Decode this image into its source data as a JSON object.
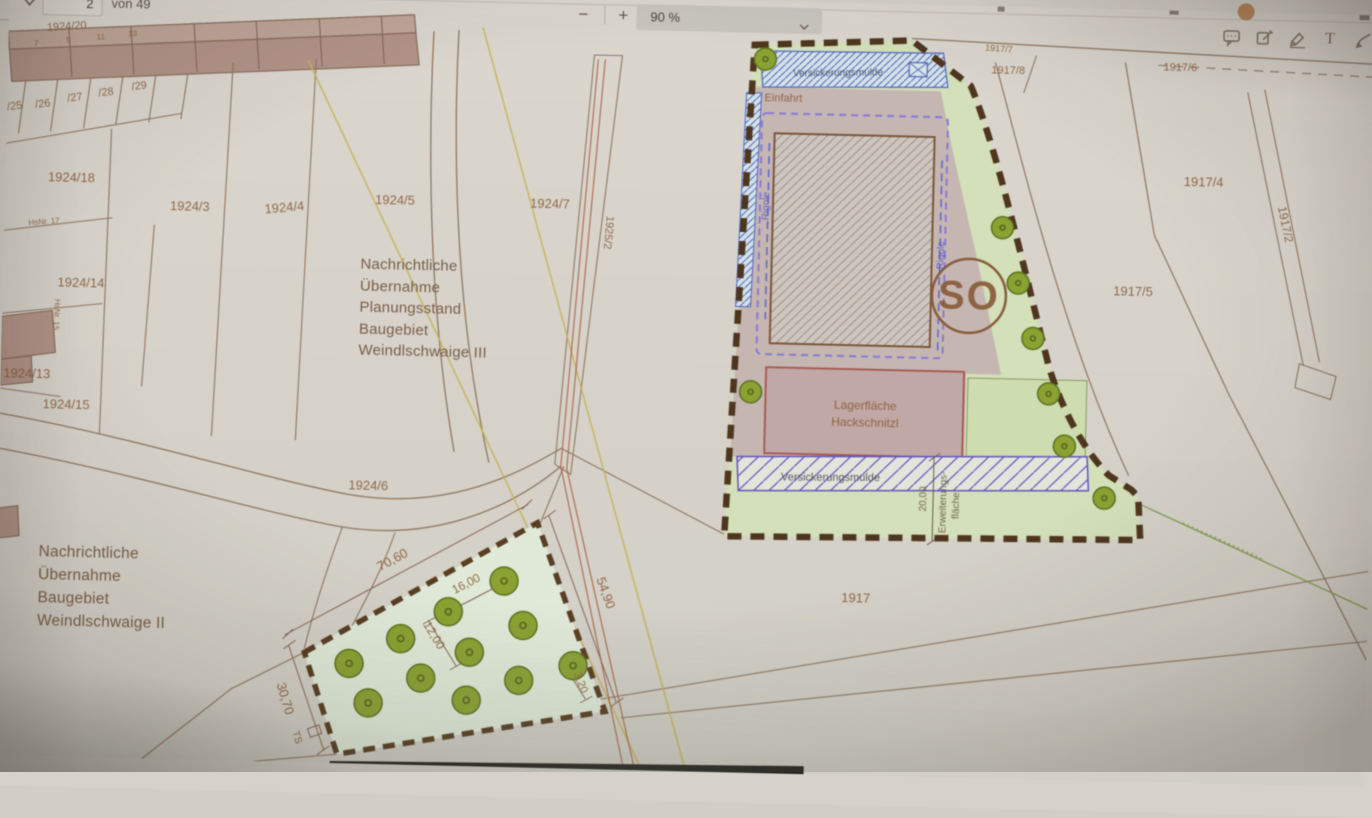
{
  "toolbar": {
    "page_value": "2",
    "page_total_label": "von 49",
    "zoom_out_label": "−",
    "zoom_in_label": "+",
    "zoom_level": "90 %",
    "text_tool_glyph": "T"
  },
  "map": {
    "notes": [
      {
        "lines": [
          "Nachrichtliche",
          "Übernahme",
          "Planungsstand",
          "Baugebiet",
          "Weindlschwaige III"
        ]
      },
      {
        "lines": [
          "Nachrichtliche",
          "Übernahme",
          "Baugebiet",
          "Weindlschwaige II"
        ]
      }
    ],
    "labels": [
      {
        "t": "1924/20",
        "x": 58,
        "y": 45,
        "r": -5,
        "s": 11
      },
      {
        "t": "7",
        "x": 28,
        "y": 62,
        "r": -4,
        "s": 8
      },
      {
        "t": "9",
        "x": 60,
        "y": 58,
        "r": -4,
        "s": 8
      },
      {
        "t": "11",
        "x": 92,
        "y": 54,
        "r": -4,
        "s": 8
      },
      {
        "t": "13",
        "x": 124,
        "y": 50,
        "r": -4,
        "s": 8
      },
      {
        "t": "/25",
        "x": 8,
        "y": 126,
        "r": -8,
        "s": 11
      },
      {
        "t": "/26",
        "x": 36,
        "y": 123,
        "r": -8,
        "s": 11
      },
      {
        "t": "/27",
        "x": 68,
        "y": 116,
        "r": -8,
        "s": 11
      },
      {
        "t": "/28",
        "x": 99,
        "y": 110,
        "r": -8,
        "s": 11
      },
      {
        "t": "/29",
        "x": 132,
        "y": 103,
        "r": -8,
        "s": 11
      },
      {
        "t": "1924/18",
        "x": 66,
        "y": 197,
        "r": 0,
        "s": 13
      },
      {
        "t": "HsNr. 17",
        "x": 40,
        "y": 240,
        "r": -6,
        "s": 8
      },
      {
        "t": "1924/14",
        "x": 78,
        "y": 302,
        "r": 0,
        "s": 13
      },
      {
        "t": "HsNr. 15",
        "x": 52,
        "y": 330,
        "r": 92,
        "s": 8
      },
      {
        "t": "1924/13",
        "x": 26,
        "y": 394,
        "r": 0,
        "s": 13
      },
      {
        "t": "1924/15",
        "x": 66,
        "y": 424,
        "r": 0,
        "s": 13
      },
      {
        "t": "1924/3",
        "x": 185,
        "y": 223,
        "r": 0,
        "s": 13
      },
      {
        "t": "1924/4",
        "x": 280,
        "y": 222,
        "r": -6,
        "s": 13
      },
      {
        "t": "1924/5",
        "x": 390,
        "y": 212,
        "r": 0,
        "s": 13
      },
      {
        "t": "1924/7",
        "x": 545,
        "y": 212,
        "r": 0,
        "s": 13
      },
      {
        "t": "1925/2",
        "x": 601,
        "y": 235,
        "r": 94,
        "s": 11
      },
      {
        "t": "1924/6",
        "x": 370,
        "y": 498,
        "r": 0,
        "s": 13
      },
      {
        "t": "1917/7",
        "x": 990,
        "y": 45,
        "r": 3,
        "s": 9
      },
      {
        "t": "1917/8",
        "x": 1000,
        "y": 67,
        "r": 0,
        "s": 11
      },
      {
        "t": "1917/6",
        "x": 1172,
        "y": 60,
        "r": 0,
        "s": 11
      },
      {
        "t": "1917/4",
        "x": 1198,
        "y": 175,
        "r": 0,
        "s": 13
      },
      {
        "t": "1917/2",
        "x": 1277,
        "y": 212,
        "r": 77,
        "s": 12
      },
      {
        "t": "1917/5",
        "x": 1130,
        "y": 286,
        "r": 0,
        "s": 13
      },
      {
        "t": "1917",
        "x": 860,
        "y": 599,
        "r": 0,
        "s": 13
      },
      {
        "t": "Versickerungsmulde",
        "x": 830,
        "y": 73,
        "r": -2,
        "s": 10,
        "c": "navy"
      },
      {
        "t": "Einfahrt",
        "x": 776,
        "y": 100,
        "r": 0,
        "s": 11
      },
      {
        "t": "Rigole",
        "x": 764,
        "y": 205,
        "r": -90,
        "s": 10,
        "c": "violet"
      },
      {
        "t": "Rigole",
        "x": 940,
        "y": 250,
        "r": -90,
        "s": 10,
        "c": "violet"
      },
      {
        "t": "SO",
        "x": 966,
        "y": 303,
        "r": 0,
        "s": 40,
        "c": "so",
        "w": "700",
        "ls": 2
      },
      {
        "t": "Lagerfläche",
        "x": 865,
        "y": 406,
        "r": 0,
        "s": 12
      },
      {
        "t": "Hackschnitzl",
        "x": 865,
        "y": 423,
        "r": 0,
        "s": 12
      },
      {
        "t": "Versickerungsmulde",
        "x": 832,
        "y": 478,
        "r": -1,
        "s": 11,
        "c": "dark"
      },
      {
        "t": "20,00",
        "x": 928,
        "y": 494,
        "r": -90,
        "s": 10,
        "c": "gray"
      },
      {
        "t": "Erweiterungs-",
        "x": 948,
        "y": 497,
        "r": -90,
        "s": 10,
        "c": "gray"
      },
      {
        "t": "fläche",
        "x": 961,
        "y": 500,
        "r": -90,
        "s": 10,
        "c": "gray"
      },
      {
        "t": "70,60",
        "x": 398,
        "y": 571,
        "r": -30,
        "s": 13
      },
      {
        "t": "54,90",
        "x": 606,
        "y": 597,
        "r": 69,
        "s": 13
      },
      {
        "t": "30,70",
        "x": 288,
        "y": 710,
        "r": 72,
        "s": 13
      },
      {
        "t": "16,00",
        "x": 472,
        "y": 593,
        "r": -29,
        "s": 12
      },
      {
        "t": "12,00",
        "x": 436,
        "y": 644,
        "r": 57,
        "s": 12
      },
      {
        "t": "3,20",
        "x": 584,
        "y": 687,
        "r": 68,
        "s": 11
      },
      {
        "t": "TS",
        "x": 302,
        "y": 748,
        "r": 72,
        "s": 10
      }
    ],
    "trees": {
      "site": {
        "r": 11,
        "pts": [
          [
            757,
            58
          ],
          [
            750,
            391
          ],
          [
            998,
            221
          ],
          [
            1015,
            276
          ],
          [
            1031,
            331
          ],
          [
            1048,
            386
          ],
          [
            1065,
            438
          ],
          [
            1106,
            489
          ]
        ]
      },
      "planting": {
        "r": 14,
        "pts": [
          [
            508,
            586
          ],
          [
            453,
            618
          ],
          [
            528,
            630
          ],
          [
            406,
            646
          ],
          [
            475,
            658
          ],
          [
            355,
            672
          ],
          [
            427,
            685
          ],
          [
            525,
            685
          ],
          [
            579,
            669
          ],
          [
            375,
            711
          ],
          [
            473,
            706
          ]
        ]
      }
    }
  }
}
